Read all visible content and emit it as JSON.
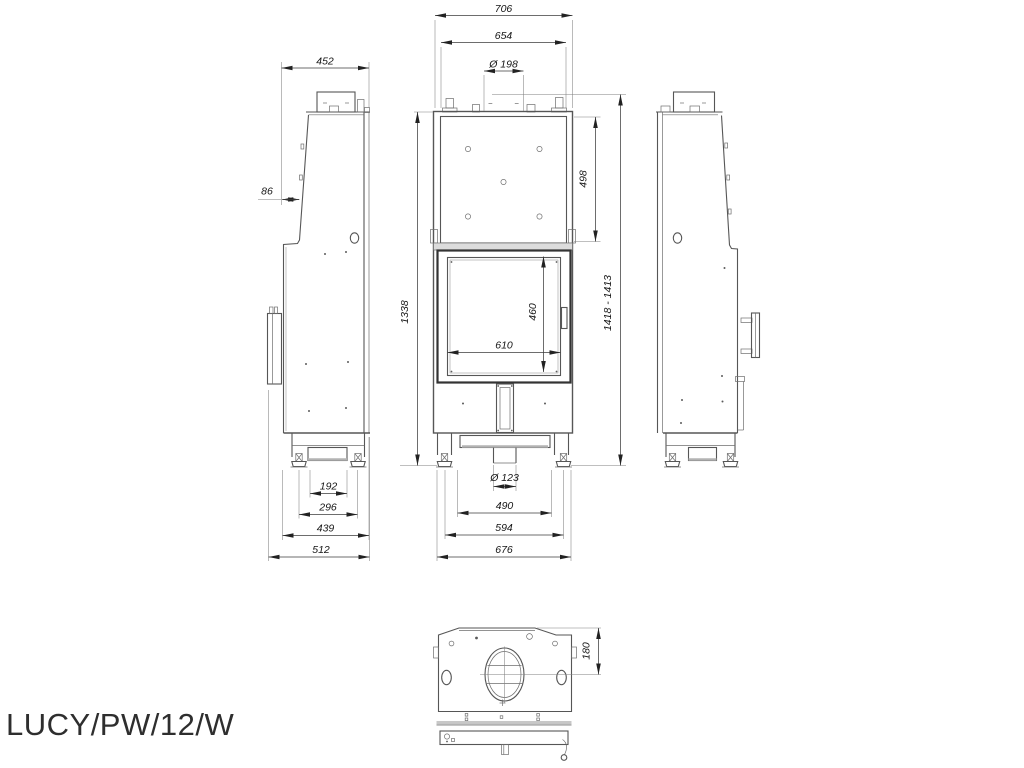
{
  "product": {
    "model": "LUCY/PW/12/W"
  },
  "dims": {
    "front": {
      "overall_w": "706",
      "body_w": "654",
      "flue_d": "Ø 198",
      "panel_h": "498",
      "body_h": "1338",
      "total_h": "1418 - 1413",
      "glass_h": "460",
      "glass_w": "610",
      "intake_d": "Ø 123",
      "intake_w": "490",
      "feet_w": "594",
      "base_w": "676"
    },
    "left": {
      "depth": "452",
      "top_offset": "86",
      "base_inner": "192",
      "feet_w": "296",
      "base_w": "439",
      "overall_d": "512"
    },
    "top": {
      "flue_offset": "180"
    }
  }
}
